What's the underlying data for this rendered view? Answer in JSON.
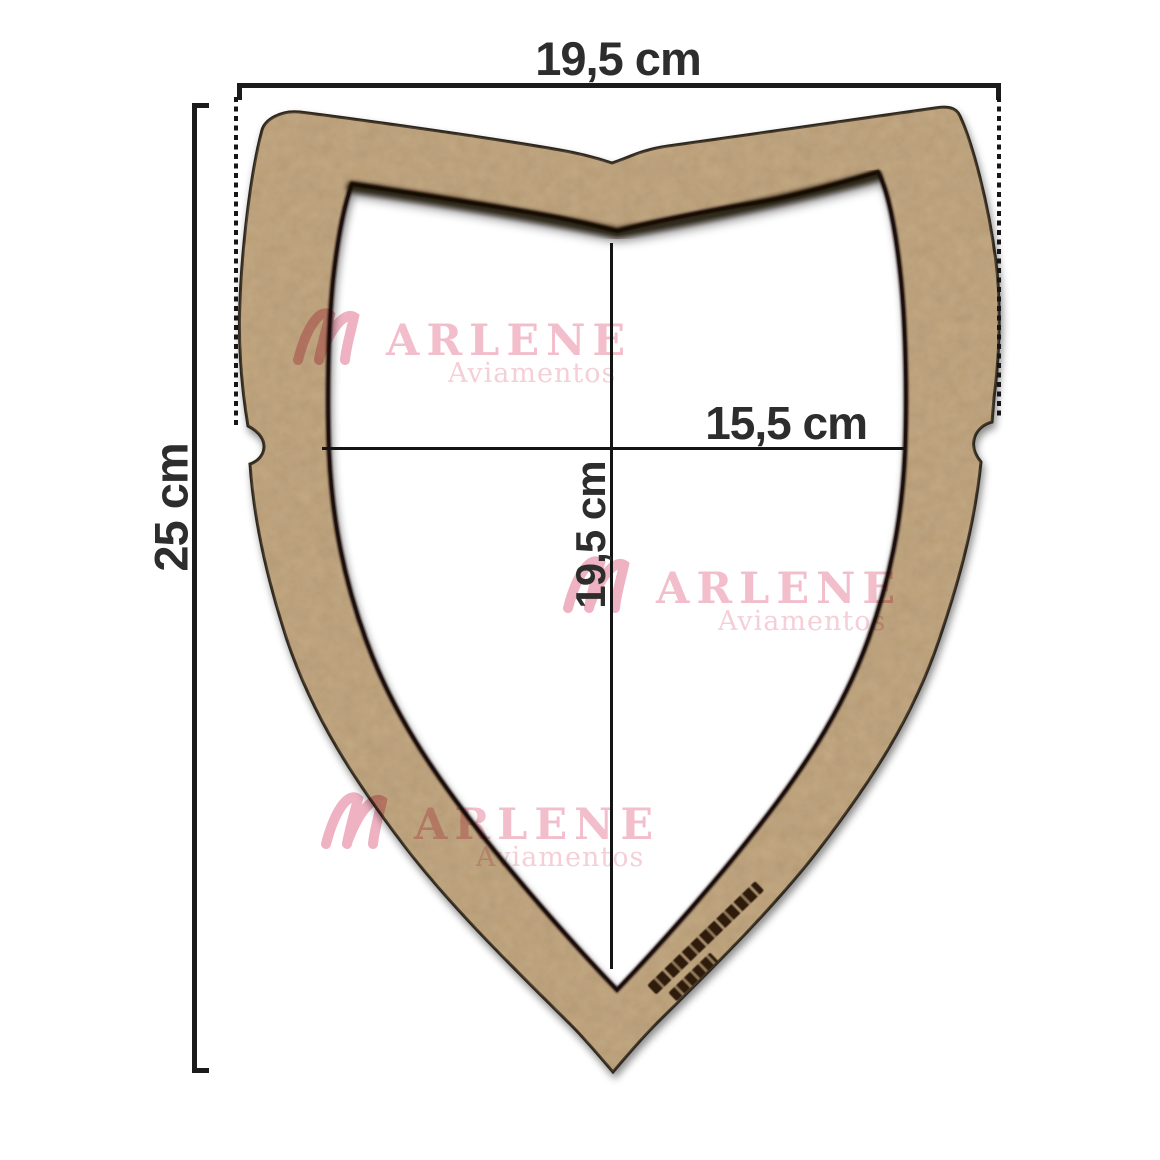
{
  "figure": {
    "type": "product-measurement-diagram",
    "product": "MDF shield-shaped frame",
    "background": "#ffffff"
  },
  "dimensions": {
    "outer_width": "19,5 cm",
    "outer_height": "25 cm",
    "inner_width": "15,5 cm",
    "inner_height": "19,5 cm"
  },
  "watermark": {
    "brand_initial": "M",
    "brand_text": "ARLENE",
    "subtitle": "Aviamentos",
    "color": "#f0aebe"
  },
  "colors": {
    "wood": "#bda179",
    "wood_grain_dark": "#47331f",
    "wood_grain_light": "#d9c29a",
    "edge_dark": "#1a1008",
    "dimension_line": "#1b1b1b",
    "label_text": "#2d2d2d"
  }
}
